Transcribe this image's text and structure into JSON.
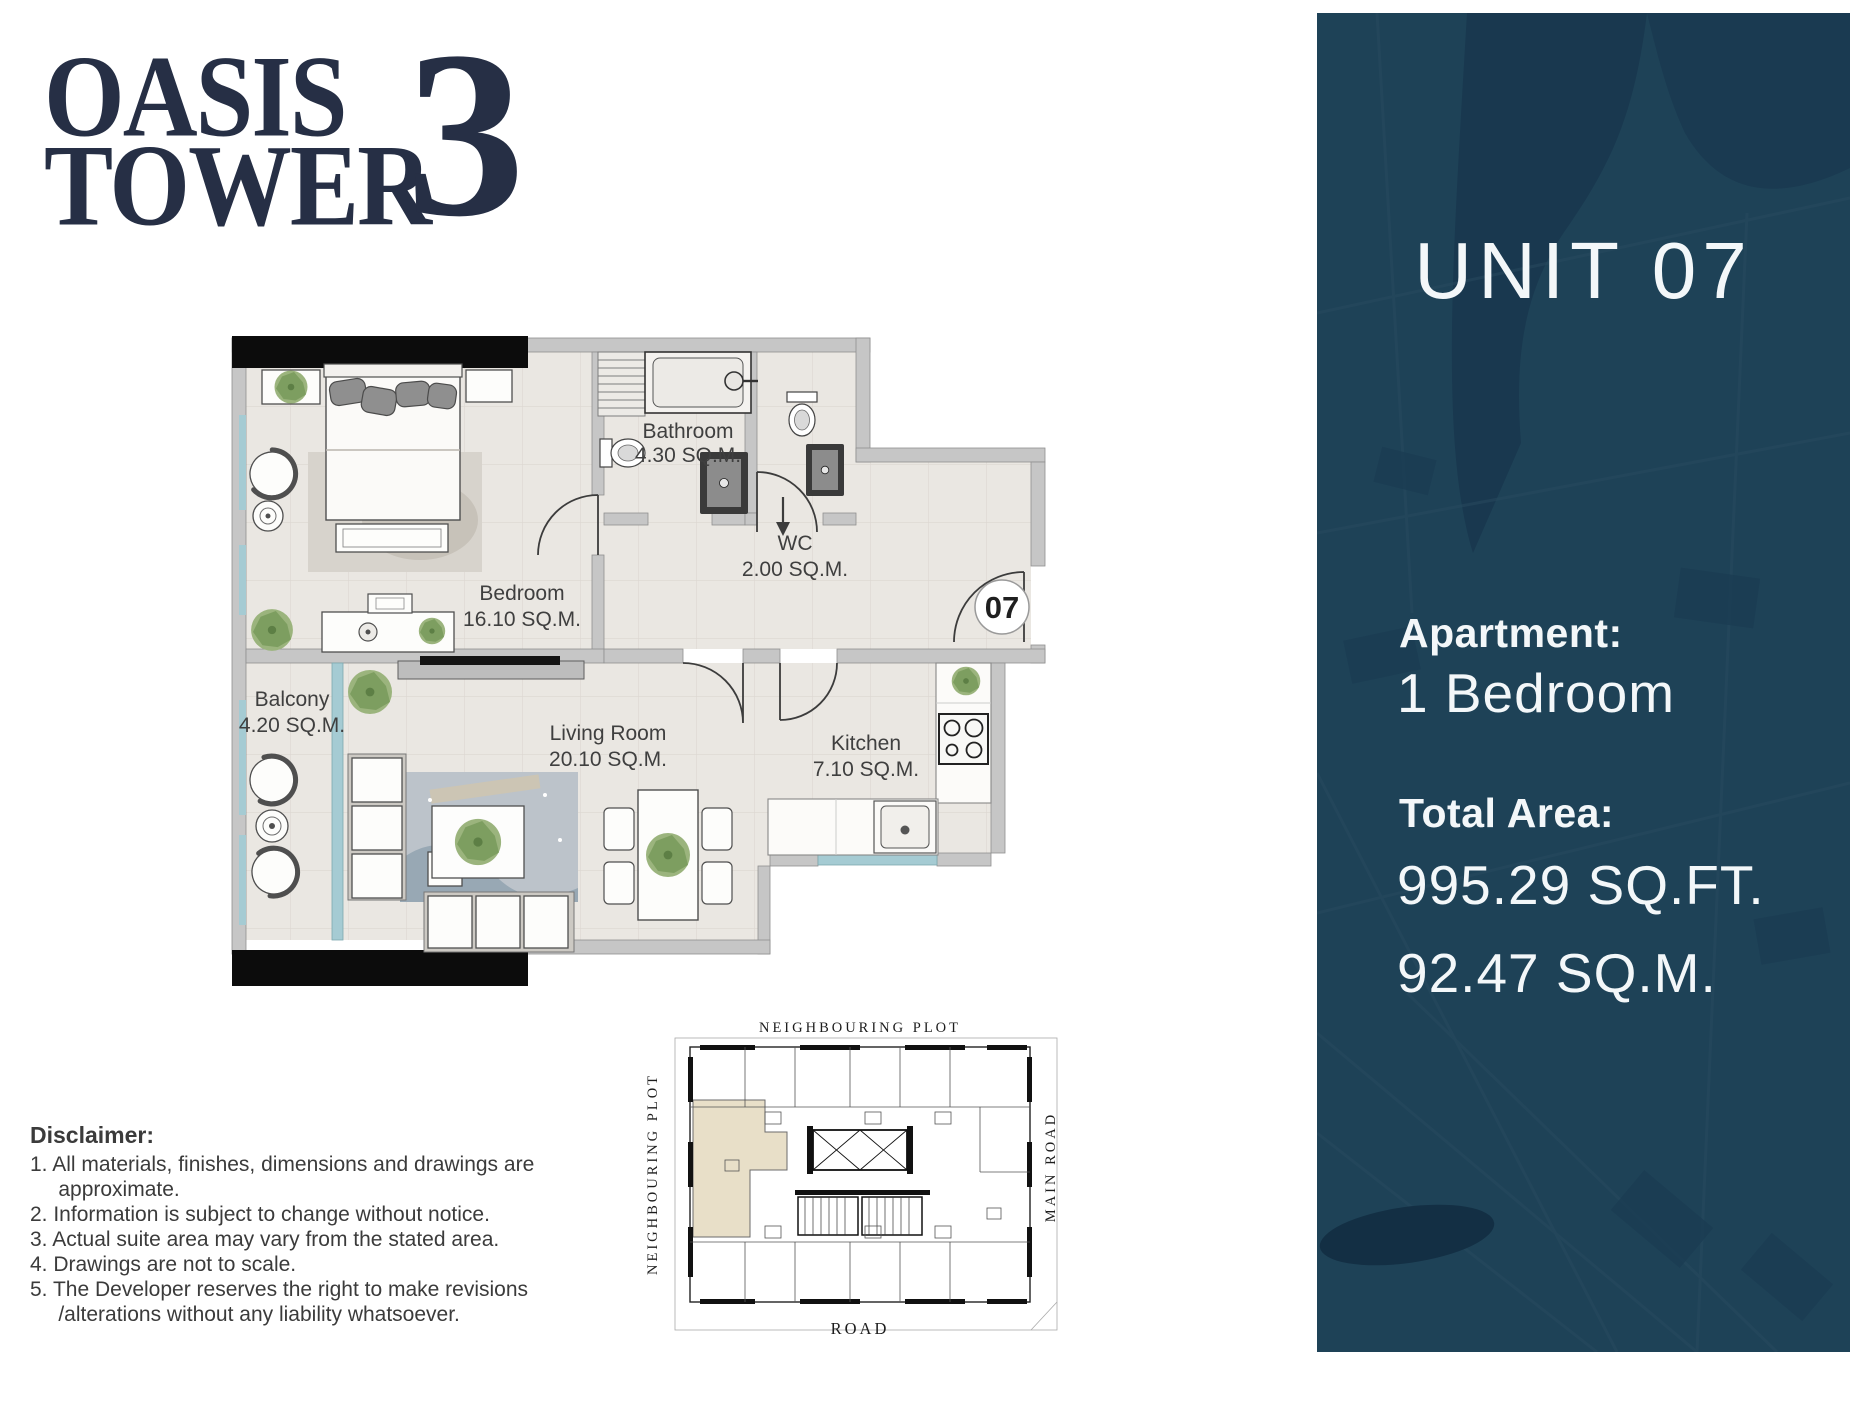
{
  "logo": {
    "word1": "OASIS",
    "word2": "TOWER",
    "number": "3"
  },
  "panel": {
    "unit_title": "UNIT 07",
    "apartment_label": "Apartment:",
    "apartment_value": "1 Bedroom",
    "total_area_label": "Total Area:",
    "area_sqft": "995.29 SQ.FT.",
    "area_sqm": "92.47 SQ.M."
  },
  "floor_plan": {
    "unit_marker": "07",
    "rooms": [
      {
        "name": "Bedroom",
        "area": "16.10 SQ.M."
      },
      {
        "name": "Bathroom",
        "area": "4.30 SQ.M."
      },
      {
        "name": "WC",
        "area": "2.00 SQ.M."
      },
      {
        "name": "Balcony",
        "area": "4.20 SQ.M."
      },
      {
        "name": "Living Room",
        "area": "20.10 SQ.M."
      },
      {
        "name": "Kitchen",
        "area": "7.10 SQ.M."
      }
    ]
  },
  "key_plan": {
    "top_label": "NEIGHBOURING PLOT",
    "left_label": "NEIGHBOURING PLOT",
    "right_label": "MAIN ROAD",
    "bottom_label": "ROAD"
  },
  "disclaimer": {
    "heading": "Disclaimer:",
    "items": [
      "1. All materials, finishes, dimensions and drawings are approximate.",
      "2. Information is subject to change without notice.",
      "3. Actual suite area may vary from the stated area.",
      "4. Drawings are not to scale.",
      "5. The Developer reserves the right to make revisions /alterations without any liability whatsoever."
    ]
  },
  "colors": {
    "panel_bg": "#1e4257",
    "logo_navy": "#262f45",
    "window_teal": "#a5cbd3",
    "unit_highlight": "#e8dfc8",
    "wall_gray": "#c6c6c6",
    "floor_tile": "#eae7e2"
  }
}
